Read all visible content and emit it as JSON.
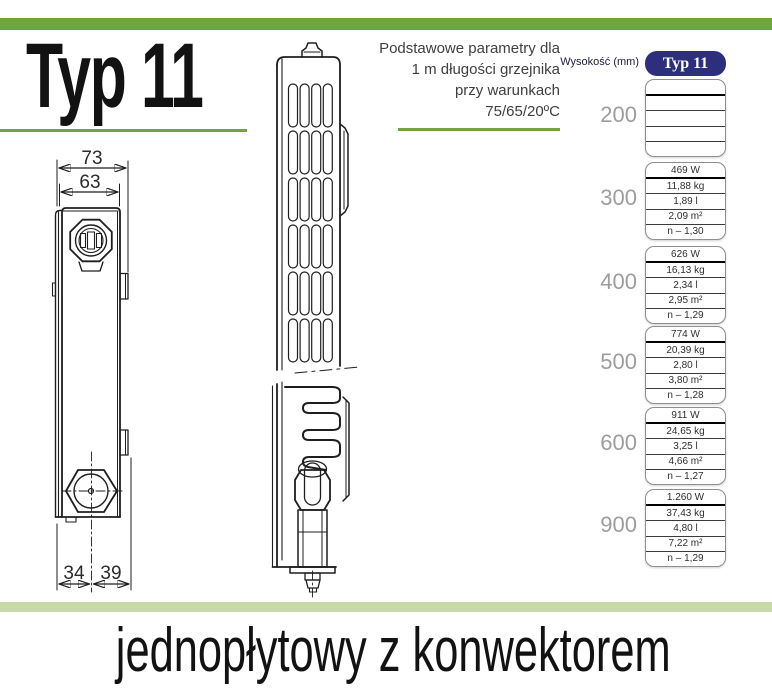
{
  "page": {
    "title": "Typ 11",
    "subtitle_lines": [
      "Podstawowe parametry dla",
      "1 m długości grzejnika",
      "przy warunkach",
      "75/65/20ºC"
    ],
    "footer": "jednopłytowy z konwektorem",
    "accent_green": "#6ca63c",
    "pale_green": "#c7d9a7",
    "navy": "#2d2f7c"
  },
  "drawing": {
    "dims": {
      "outer_width": "73",
      "inner_width": "63",
      "bottom_left": "34",
      "bottom_right": "39"
    }
  },
  "table": {
    "row_header": "Wysokość (mm)",
    "col_header": "Typ 11",
    "unit_order": [
      "W",
      "kg",
      "l",
      "m²",
      "n"
    ],
    "rows": [
      {
        "height": "200",
        "values": [
          "",
          "",
          "",
          "",
          ""
        ]
      },
      {
        "height": "300",
        "values": [
          "469 W",
          "11,88 kg",
          "1,89 l",
          "2,09 m²",
          "n – 1,30"
        ]
      },
      {
        "height": "400",
        "values": [
          "626 W",
          "16,13 kg",
          "2,34 l",
          "2,95 m²",
          "n – 1,29"
        ]
      },
      {
        "height": "500",
        "values": [
          "774 W",
          "20,39 kg",
          "2,80 l",
          "3,80 m²",
          "n – 1,28"
        ]
      },
      {
        "height": "600",
        "values": [
          "911 W",
          "24,65 kg",
          "3,25 l",
          "4,66 m²",
          "n – 1,27"
        ]
      },
      {
        "height": "900",
        "values": [
          "1.260 W",
          "37,43 kg",
          "4,80 l",
          "7,22 m²",
          "n – 1,29"
        ]
      }
    ]
  }
}
